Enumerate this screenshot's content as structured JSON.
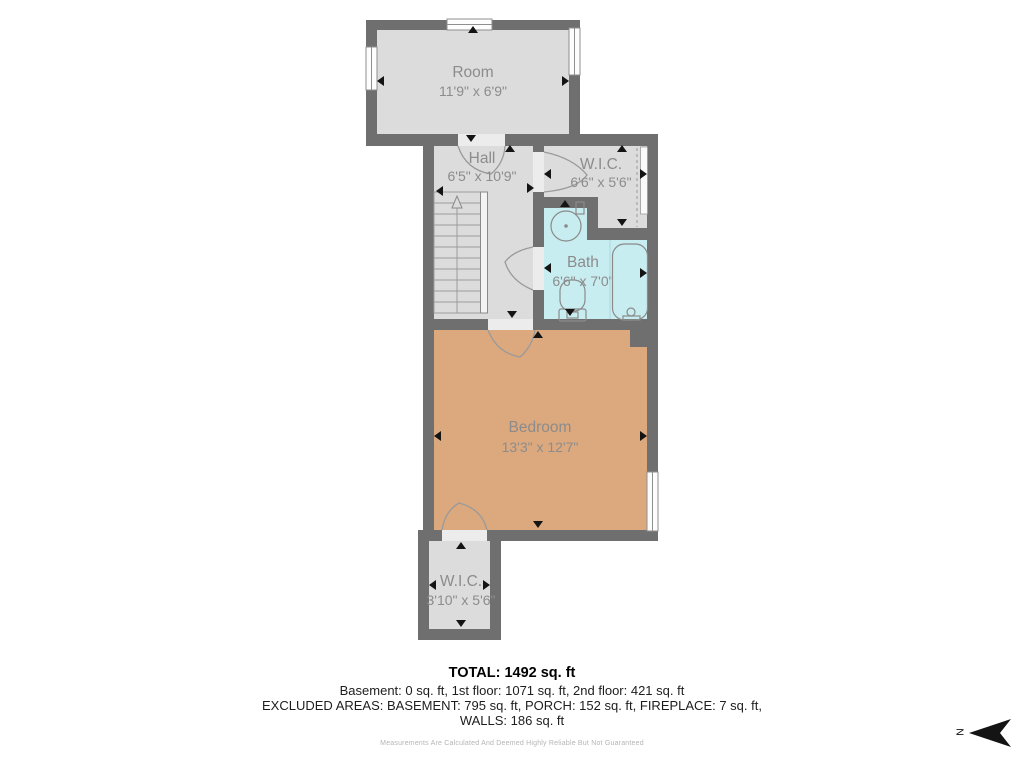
{
  "rooms": [
    {
      "name": "Room",
      "dims": "11'9\" x 6'9\""
    },
    {
      "name": "Hall",
      "dims": "6'5\" x 10'9\""
    },
    {
      "name": "W.I.C.",
      "dims": "6'6\" x 5'6\""
    },
    {
      "name": "Bath",
      "dims": "6'6\" x 7'0\""
    },
    {
      "name": "Bedroom",
      "dims": "13'3\" x 12'7\""
    },
    {
      "name": "W.I.C.",
      "dims": "3'10\" x 5'6\""
    }
  ],
  "summary": {
    "total": "TOTAL: 1492 sq. ft",
    "floors": "Basement: 0 sq. ft, 1st floor: 1071 sq. ft, 2nd floor: 421 sq. ft",
    "excluded": "EXCLUDED AREAS: BASEMENT: 795 sq. ft, PORCH: 152 sq. ft, FIREPLACE: 7 sq. ft,",
    "walls": "WALLS: 186 sq. ft",
    "disclaimer": "Measurements Are Calculated And Deemed Highly Reliable But Not Guaranteed"
  },
  "compass": {
    "letter": "N"
  },
  "colors": {
    "wall": "#6f6f6f",
    "floor": "#dcdcdc",
    "bath_floor": "#c8edf0",
    "bedroom_floor": "#dca87e",
    "room_label": "#8c8c8c",
    "summary_text": "#1d1d1d",
    "disclaimer_text": "#b5b5b5"
  }
}
